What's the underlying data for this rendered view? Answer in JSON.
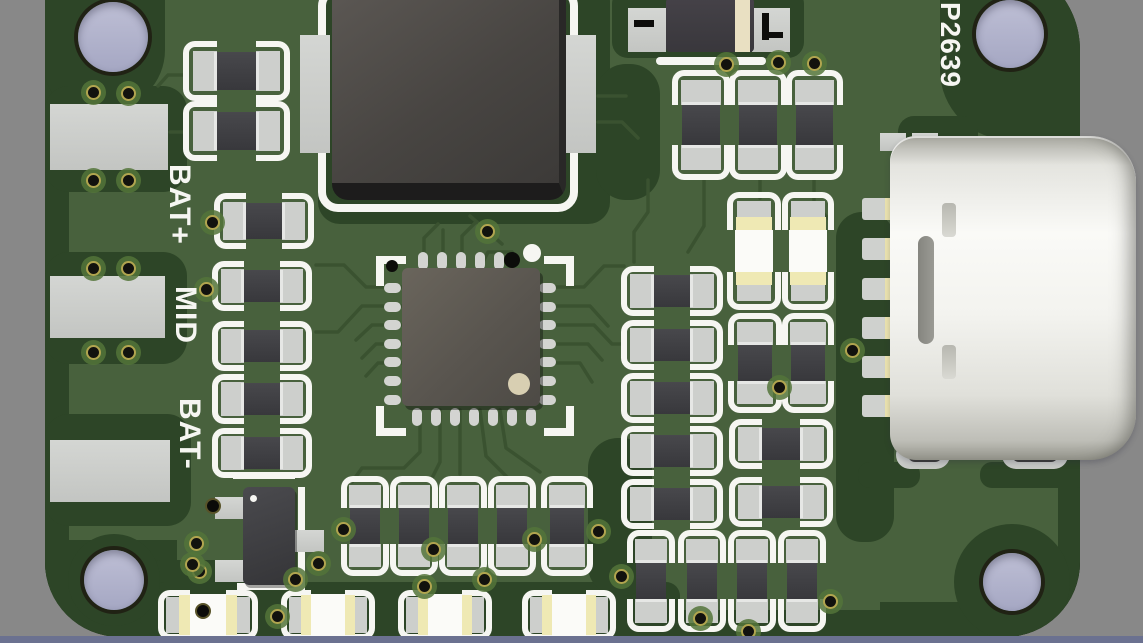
{
  "meta": {
    "view": "pcb-3d-render",
    "board_reference": "P2639",
    "silkscreen_labels": [
      "BAT+",
      "MID",
      "BAT-"
    ],
    "colors": {
      "background_top": "#c6c7db",
      "background_bottom": "#9a9cb8",
      "pcb_green": "#48613d",
      "pcb_dark_zone": "#2d4527",
      "trace": "#3a5230",
      "silkscreen": "#f6f6f2",
      "pad_gray": "#cdcfcc",
      "component_body": "#3b3b3f",
      "led_yellow": "#efe9b4",
      "usb_metal": "#f3f3ef",
      "hole_fill": "#b0b2cc",
      "bottom_bar": "#6b7190",
      "via_gold": "#cec05a"
    }
  },
  "labels": [
    {
      "text": "BAT+",
      "x": 194,
      "y": 164,
      "size": 30
    },
    {
      "text": "MID",
      "x": 200,
      "y": 286,
      "size": 30
    },
    {
      "text": "BAT-",
      "x": 204,
      "y": 398,
      "size": 30
    },
    {
      "text": "P2639",
      "x": 964,
      "y": 2,
      "size": 28
    }
  ],
  "zones": [
    [
      45,
      0,
      24,
      637,
      "0"
    ],
    [
      45,
      0,
      120,
      110,
      "0 0 60px 40px"
    ],
    [
      45,
      86,
      142,
      106,
      "24px"
    ],
    [
      45,
      252,
      142,
      112,
      "24px"
    ],
    [
      45,
      414,
      146,
      112,
      "24px"
    ],
    [
      45,
      540,
      132,
      97,
      "0 0 0 70px"
    ],
    [
      140,
      560,
      110,
      77,
      "20px"
    ],
    [
      150,
      582,
      530,
      55,
      "14px"
    ],
    [
      660,
      610,
      232,
      27,
      "8px"
    ],
    [
      318,
      -20,
      292,
      244,
      "22px"
    ],
    [
      612,
      -12,
      192,
      70,
      "16px"
    ],
    [
      596,
      64,
      64,
      136,
      "30px"
    ],
    [
      836,
      212,
      58,
      330,
      "26px"
    ],
    [
      940,
      0,
      140,
      140,
      "0 0 0 70px"
    ],
    [
      1058,
      0,
      22,
      637,
      "0"
    ],
    [
      898,
      116,
      80,
      36,
      "16px"
    ],
    [
      858,
      462,
      62,
      26,
      "12px"
    ],
    [
      980,
      462,
      108,
      26,
      "12px"
    ],
    [
      880,
      602,
      200,
      35,
      "0"
    ],
    [
      954,
      524,
      116,
      116,
      "50%"
    ],
    [
      68,
      534,
      92,
      92,
      "50%"
    ],
    [
      588,
      438,
      64,
      158,
      "30px"
    ]
  ],
  "traces": [
    [
      [
        402,
        287
      ],
      [
        366,
        287
      ],
      [
        344,
        265
      ],
      [
        316,
        265
      ]
    ],
    [
      [
        402,
        306
      ],
      [
        362,
        306
      ],
      [
        338,
        332
      ],
      [
        316,
        332
      ]
    ],
    [
      [
        402,
        325
      ],
      [
        372,
        325
      ],
      [
        356,
        340
      ]
    ],
    [
      [
        402,
        344
      ],
      [
        376,
        344
      ],
      [
        362,
        358
      ]
    ],
    [
      [
        402,
        363
      ],
      [
        378,
        363
      ],
      [
        366,
        376
      ]
    ],
    [
      [
        540,
        287
      ],
      [
        584,
        287
      ],
      [
        604,
        266
      ],
      [
        624,
        266
      ]
    ],
    [
      [
        540,
        306
      ],
      [
        590,
        306
      ],
      [
        608,
        326
      ]
    ],
    [
      [
        540,
        325
      ],
      [
        594,
        325
      ],
      [
        612,
        344
      ],
      [
        624,
        344
      ]
    ],
    [
      [
        540,
        344
      ],
      [
        588,
        344
      ],
      [
        602,
        360
      ]
    ],
    [
      [
        540,
        363
      ],
      [
        580,
        363
      ],
      [
        592,
        382
      ]
    ],
    [
      [
        420,
        410
      ],
      [
        420,
        452
      ],
      [
        404,
        468
      ],
      [
        362,
        468
      ],
      [
        352,
        482
      ]
    ],
    [
      [
        440,
        410
      ],
      [
        440,
        462
      ],
      [
        432,
        478
      ]
    ],
    [
      [
        460,
        410
      ],
      [
        460,
        474
      ]
    ],
    [
      [
        480,
        410
      ],
      [
        486,
        456
      ],
      [
        508,
        478
      ]
    ],
    [
      [
        500,
        410
      ],
      [
        506,
        448
      ],
      [
        540,
        472
      ]
    ],
    [
      [
        424,
        266
      ],
      [
        424,
        238
      ],
      [
        438,
        224
      ]
    ],
    [
      [
        443,
        266
      ],
      [
        443,
        230
      ]
    ],
    [
      [
        462,
        266
      ],
      [
        462,
        236
      ],
      [
        476,
        222
      ]
    ],
    [
      [
        481,
        266
      ],
      [
        488,
        252
      ],
      [
        512,
        252
      ]
    ],
    [
      [
        470,
        216
      ],
      [
        502,
        244
      ]
    ],
    [
      [
        648,
        180
      ],
      [
        648,
        212
      ],
      [
        634,
        232
      ],
      [
        634,
        262
      ]
    ],
    [
      [
        704,
        180
      ],
      [
        704,
        226
      ],
      [
        688,
        252
      ]
    ],
    [
      [
        760,
        180
      ],
      [
        760,
        198
      ]
    ],
    [
      [
        814,
        180
      ],
      [
        814,
        204
      ],
      [
        830,
        220
      ]
    ],
    [
      [
        598,
        96
      ],
      [
        626,
        96
      ]
    ],
    [
      [
        598,
        122
      ],
      [
        622,
        122
      ],
      [
        638,
        138
      ]
    ],
    [
      [
        186,
        75
      ],
      [
        168,
        75
      ],
      [
        158,
        86
      ]
    ],
    [
      [
        186,
        132
      ],
      [
        170,
        132
      ]
    ]
  ],
  "left_pads": [
    [
      50,
      104,
      118,
      66
    ],
    [
      50,
      276,
      115,
      62
    ],
    [
      50,
      440,
      120,
      62
    ]
  ],
  "resistors_h": [
    [
      183,
      41,
      107,
      60
    ],
    [
      183,
      101,
      107,
      60
    ],
    [
      214,
      193,
      100,
      56
    ],
    [
      212,
      261,
      100,
      50
    ],
    [
      212,
      321,
      100,
      50
    ],
    [
      212,
      374,
      100,
      50
    ],
    [
      212,
      428,
      100,
      50
    ],
    [
      621,
      266,
      102,
      50
    ],
    [
      621,
      320,
      102,
      50
    ],
    [
      621,
      373,
      102,
      50
    ],
    [
      621,
      426,
      102,
      50
    ],
    [
      621,
      479,
      102,
      50
    ],
    [
      729,
      419,
      104,
      50
    ],
    [
      729,
      477,
      104,
      50
    ]
  ],
  "resistors_v": [
    [
      672,
      70,
      58,
      110
    ],
    [
      729,
      70,
      58,
      110
    ],
    [
      786,
      70,
      57,
      110
    ],
    [
      728,
      313,
      54,
      100
    ],
    [
      782,
      313,
      52,
      100
    ],
    [
      341,
      476,
      48,
      100
    ],
    [
      390,
      476,
      48,
      100
    ],
    [
      439,
      476,
      48,
      100
    ],
    [
      488,
      476,
      48,
      100
    ],
    [
      541,
      476,
      52,
      100
    ],
    [
      627,
      530,
      48,
      102
    ],
    [
      678,
      530,
      48,
      102
    ],
    [
      728,
      530,
      48,
      102
    ],
    [
      778,
      530,
      48,
      102
    ]
  ],
  "leds_v": [
    [
      727,
      192,
      54,
      118
    ],
    [
      782,
      192,
      52,
      118
    ]
  ],
  "leds_h": [
    [
      158,
      590,
      100,
      50
    ],
    [
      281,
      590,
      94,
      50
    ],
    [
      398,
      590,
      94,
      50
    ],
    [
      522,
      590,
      94,
      50
    ]
  ],
  "vias_ring": [
    [
      93,
      92
    ],
    [
      128,
      93
    ],
    [
      93,
      180
    ],
    [
      128,
      180
    ],
    [
      93,
      268
    ],
    [
      128,
      268
    ],
    [
      93,
      352
    ],
    [
      128,
      352
    ],
    [
      212,
      222
    ],
    [
      206,
      289
    ],
    [
      196,
      543
    ],
    [
      199,
      571
    ],
    [
      852,
      350
    ],
    [
      779,
      387
    ],
    [
      726,
      64
    ],
    [
      778,
      62
    ],
    [
      814,
      63
    ],
    [
      487,
      231
    ],
    [
      343,
      529
    ],
    [
      433,
      549
    ],
    [
      484,
      579
    ],
    [
      424,
      586
    ],
    [
      534,
      539
    ],
    [
      598,
      531
    ],
    [
      192,
      564
    ],
    [
      295,
      579
    ],
    [
      318,
      563
    ],
    [
      277,
      616
    ],
    [
      621,
      576
    ],
    [
      700,
      618
    ],
    [
      748,
      631
    ],
    [
      830,
      601
    ]
  ],
  "vias_dot": [
    [
      213,
      506
    ],
    [
      203,
      611
    ]
  ],
  "holes": [
    [
      78,
      2,
      70,
      70
    ],
    [
      976,
      0,
      68,
      68
    ],
    [
      84,
      550,
      60,
      60
    ],
    [
      983,
      553,
      58,
      58
    ]
  ],
  "qfn": {
    "x": 374,
    "y": 244
  },
  "inductor": {
    "x": 296,
    "y": -16
  },
  "diode": {
    "x": 626,
    "y": -2
  },
  "sot": {
    "x": 195,
    "y": 470
  },
  "usb": {
    "x": 890,
    "y": 136,
    "w": 246,
    "h": 324,
    "pads_y": [
      198,
      238,
      278,
      317,
      356,
      395
    ],
    "top_pads": [
      [
        880,
        133,
        26,
        18
      ],
      [
        912,
        133,
        26,
        18
      ]
    ],
    "mounts": [
      [
        896,
        441,
        54,
        28
      ],
      [
        1002,
        441,
        66,
        28
      ]
    ],
    "mount_slots": [
      [
        908,
        448,
        34,
        14
      ],
      [
        1012,
        448,
        46,
        14
      ]
    ],
    "dash": [
      948,
      451,
      50,
      9
    ]
  }
}
